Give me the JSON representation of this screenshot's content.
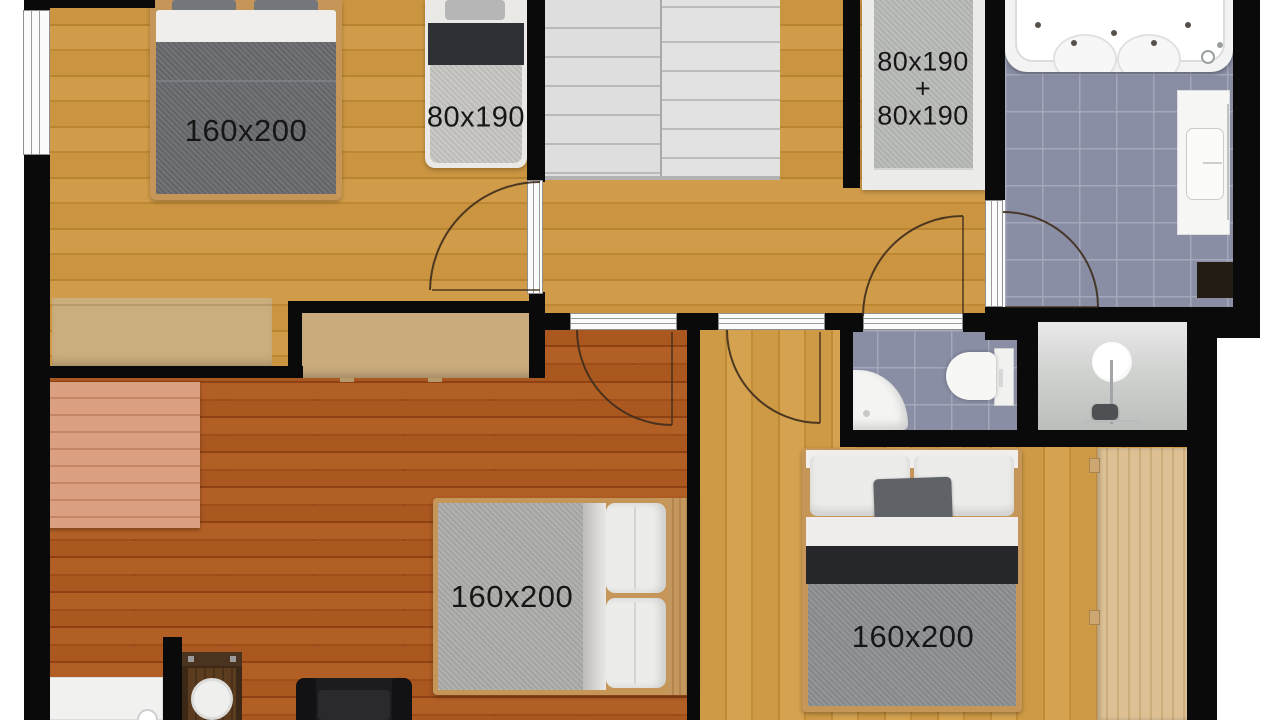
{
  "beds": {
    "top_left_double": "160x200",
    "top_left_single": "80x190",
    "hall_bunk_line1": "80x190",
    "hall_bunk_plus": "+",
    "hall_bunk_line2": "80x190",
    "living_double": "160x200",
    "bottom_right_double": "160x200"
  },
  "colors": {
    "wall": "#0a0a0a",
    "oak_floor": "#c8923e",
    "living_room_floor": "#a5521c",
    "bathroom_tile": "#8a8ea5",
    "label_text": "#161616"
  }
}
